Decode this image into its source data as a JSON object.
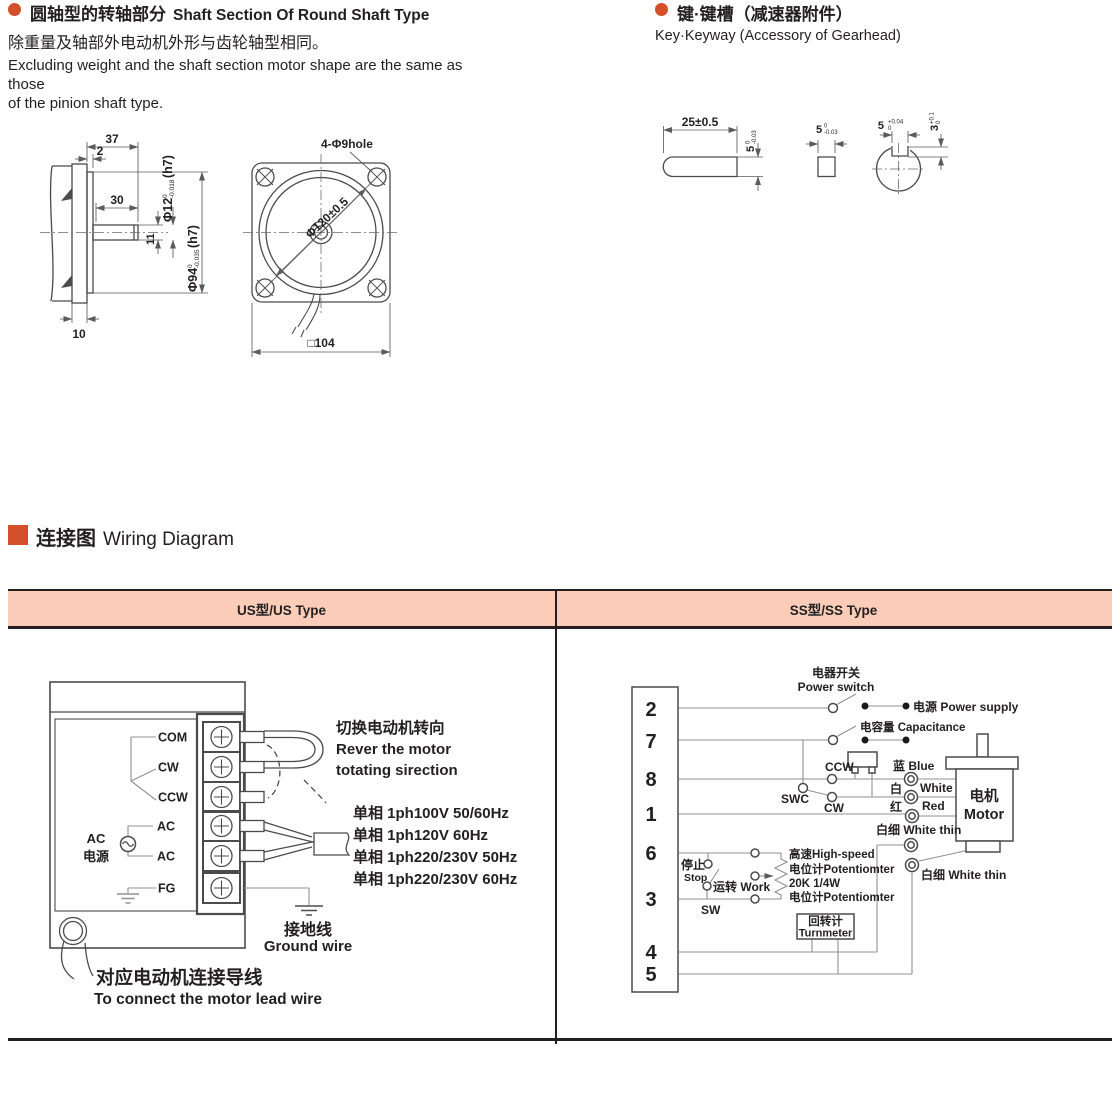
{
  "meta": {
    "accent_color": "#d4502a",
    "table_header_bg": "#fbcdb9",
    "ink_color": "#231f20"
  },
  "shaft_section": {
    "title_zh": "圆轴型的转轴部分",
    "title_en": "Shaft Section Of Round Shaft Type",
    "desc_zh": "除重量及轴部外电动机外形与齿轮轴型相同。",
    "desc_en1": "Excluding weight and the shaft section motor shape are the same as those",
    "desc_en2": "of the pinion shaft type.",
    "side_view": {
      "dim_37": "37",
      "dim_2": "2",
      "dim_30": "30",
      "dim_11": "11",
      "dim_10": "10",
      "dia12": "Φ12",
      "dia12_tol_top": "0",
      "dia12_tol_bot": "-0.018",
      "dia12_fit": "(h7)",
      "dia94": "Φ94",
      "dia94_tol_top": "0",
      "dia94_tol_bot": "-0.035",
      "dia94_fit": "(h7)"
    },
    "front_view": {
      "holes": "4-Φ9hole",
      "dia120": "Φ120±0.5",
      "square": "□104"
    }
  },
  "key_section": {
    "title_zh": "键·键槽（减速器附件）",
    "title_en": "Key·Keyway (Accessory of Gearhead)",
    "key_length": "25±0.5",
    "key_h": "5",
    "key_h_tol_top": "0",
    "key_h_tol_bot": "-0.03",
    "key_w": "5",
    "key_w_tol_top": "0",
    "key_w_tol_bot": "-0.03",
    "slot_w": "5",
    "slot_w_tol_top": "+0.04",
    "slot_w_tol_bot": "0",
    "slot_d": "3",
    "slot_d_tol_top": "+0.1",
    "slot_d_tol_bot": "0"
  },
  "wiring": {
    "title_zh": "连接图",
    "title_en": "Wiring Diagram",
    "table": {
      "col_us": "US型/US Type",
      "col_ss": "SS型/SS Type"
    },
    "us": {
      "terminals": [
        "COM",
        "CW",
        "CCW",
        "AC",
        "AC",
        "FG"
      ],
      "src_line1": "AC",
      "src_line2": "电源",
      "note_zh": "切换电动机转向",
      "note_en1": "Rever the motor",
      "note_en2": "totating sirection",
      "voltages": [
        "单相 1ph100V  50/60Hz",
        "单相 1ph120V  60Hz",
        "单相 1ph220/230V  50Hz",
        "单相 1ph220/230V  60Hz"
      ],
      "ground_zh": "接地线",
      "ground_en": "Ground wire",
      "lead_zh": "对应电动机连接导线",
      "lead_en": "To connect the motor lead wire"
    },
    "ss": {
      "terminals": [
        "2",
        "7",
        "8",
        "1",
        "6",
        "3",
        "4",
        "5"
      ],
      "power_switch_zh": "电器开关",
      "power_switch_en": "Power switch",
      "power_supply": "电源 Power supply",
      "capacitance": "电容量 Capacitance",
      "ccw": "CCW",
      "swc": "SWC",
      "cw": "CW",
      "sw": "SW",
      "blue": "蓝 Blue",
      "white_zh": "白",
      "white_en": "White",
      "red_zh": "红",
      "red_en": "Red",
      "white_thin1": "白细 White thin",
      "white_thin2": "白细 White thin",
      "motor_zh": "电机",
      "motor_en": "Motor",
      "stop_zh": "停止",
      "stop_en": "Stop",
      "work": "运转 Work",
      "pot1": "高速High-speed",
      "pot2": "电位计Potentiomter",
      "pot3": "20K  1/4W",
      "pot4": "电位计Potentiomter",
      "turnmeter_zh": "回转计",
      "turnmeter_en": "Turnmeter"
    }
  }
}
